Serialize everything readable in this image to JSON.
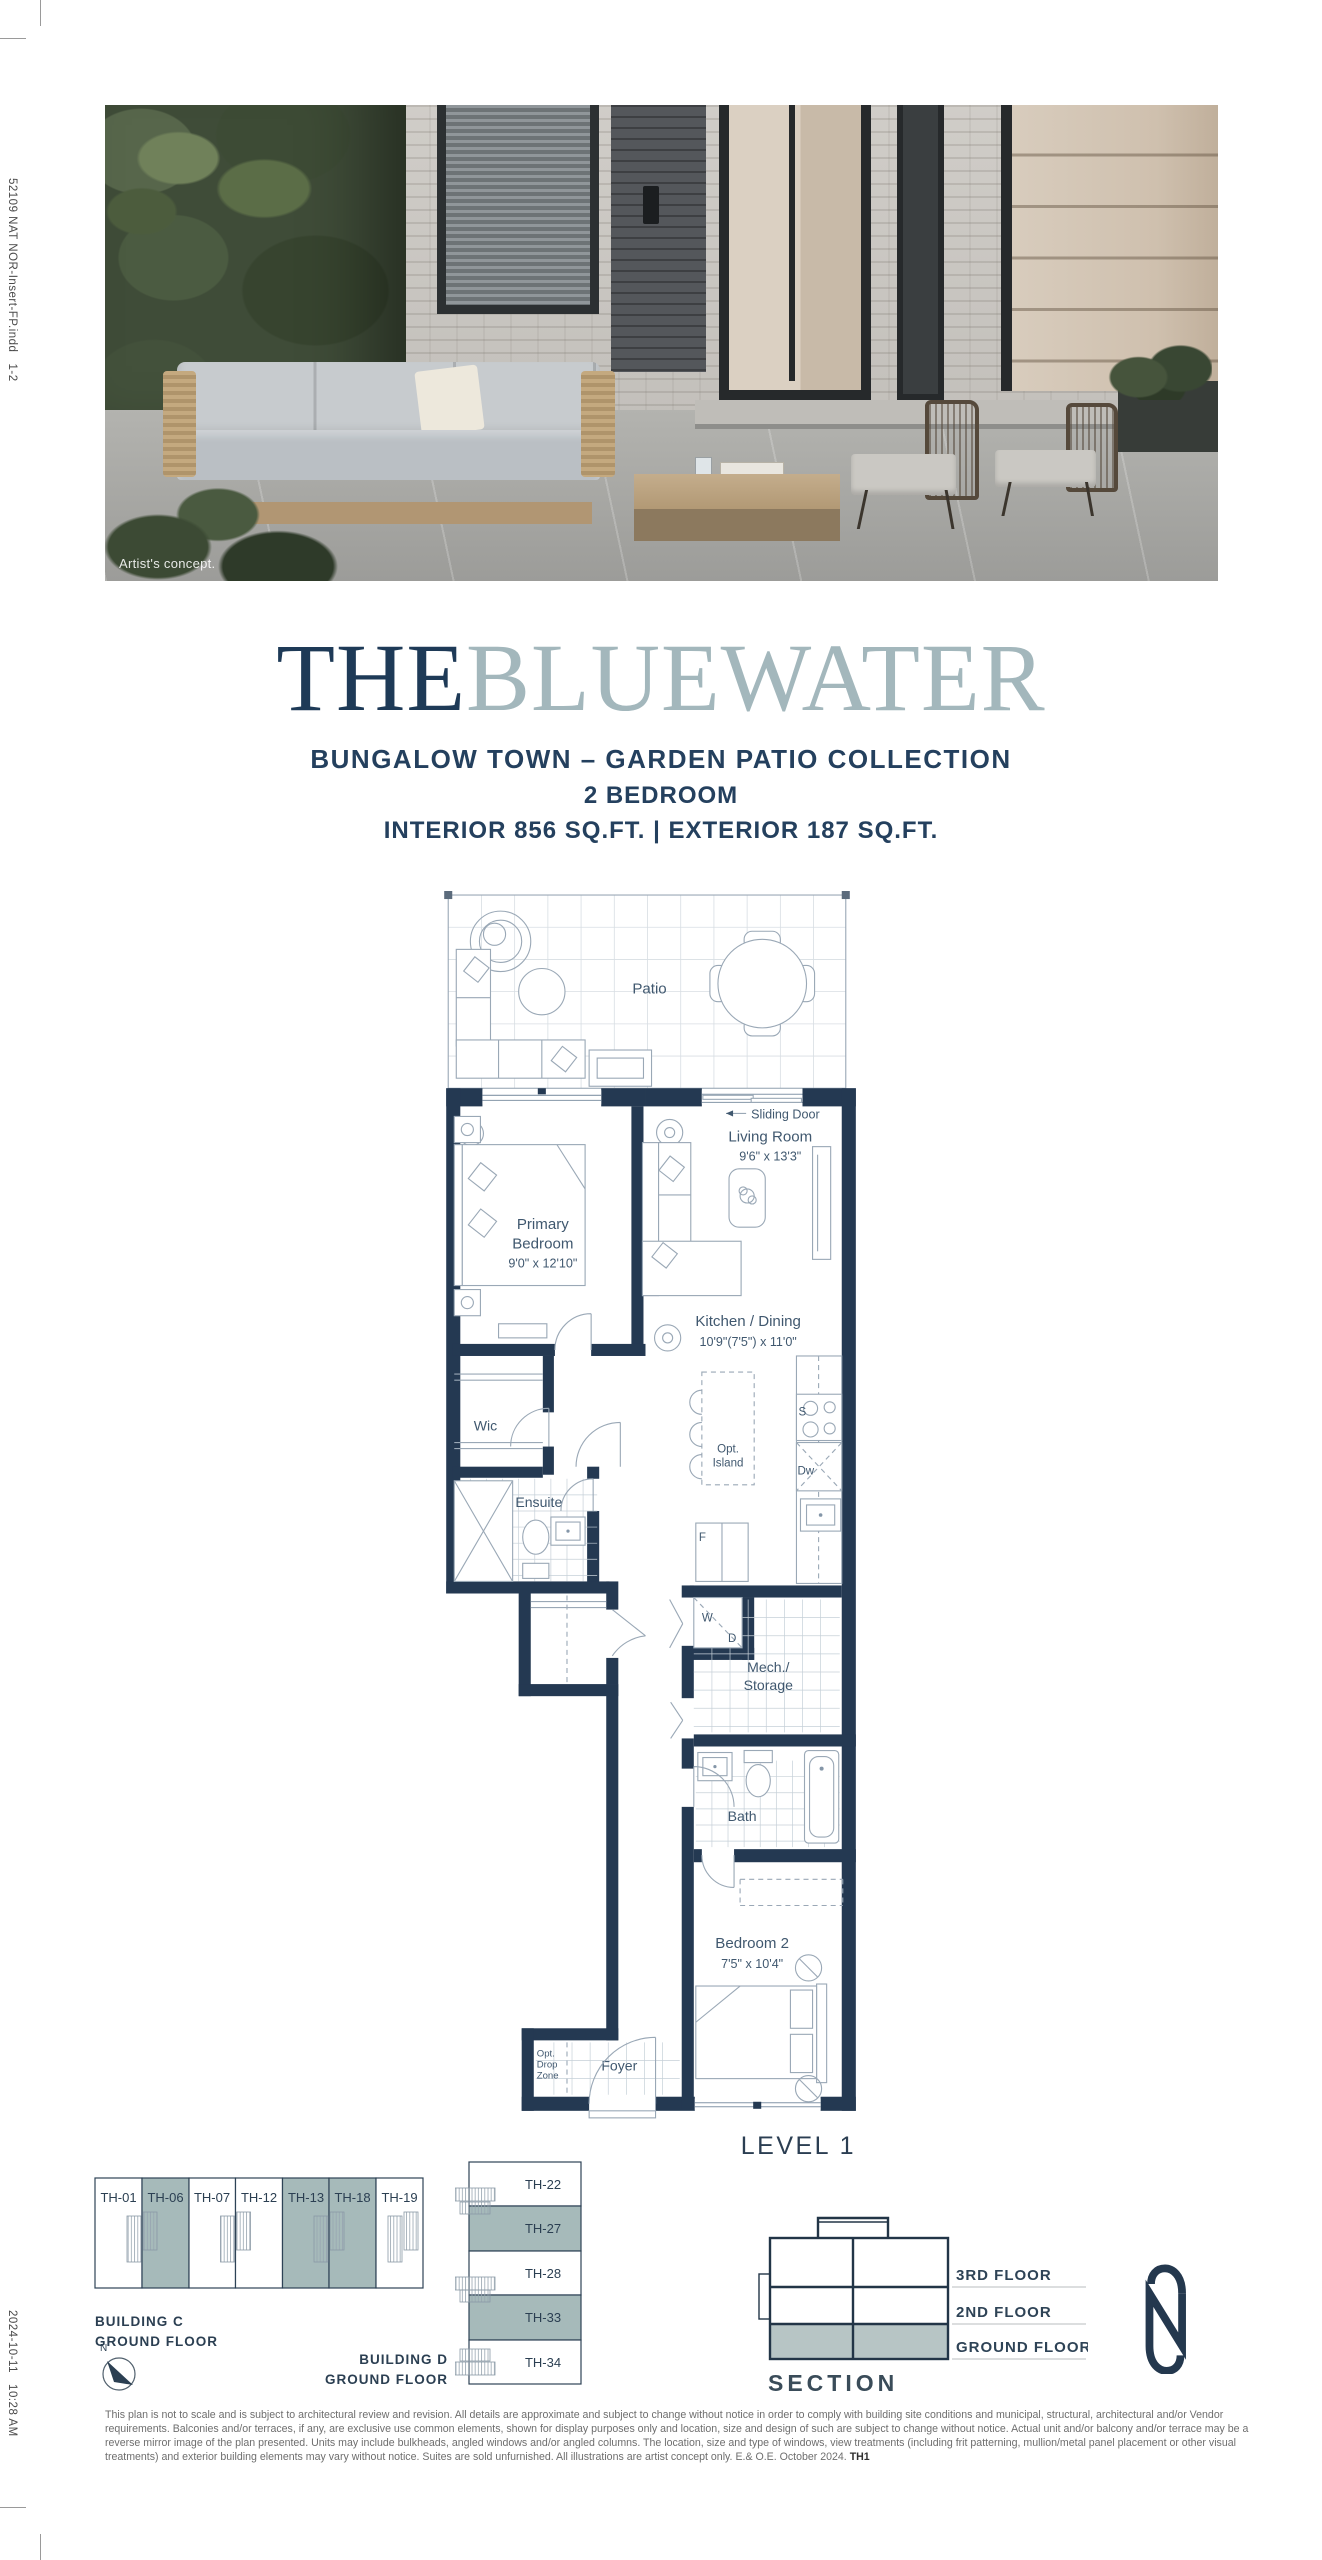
{
  "slug": {
    "top": "52109 NAT NOR-Insert-FP.indd   1-2",
    "bottom": "2024-10-11   10:28 AM"
  },
  "hero": {
    "caption": "Artist's concept."
  },
  "title": {
    "part1": "THE",
    "part2": "BLUEWATER"
  },
  "subtitle": {
    "collection": "BUNGALOW TOWN – GARDEN PATIO COLLECTION",
    "bedrooms": "2 BEDROOM",
    "area": "INTERIOR 856 SQ.FT.  |  EXTERIOR 187 SQ.FT."
  },
  "floorplan": {
    "level": "LEVEL 1",
    "patio": "Patio",
    "sliding_door": "Sliding Door",
    "living": {
      "name": "Living Room",
      "dims": "9'6\" x 13'3\""
    },
    "primary": {
      "name1": "Primary",
      "name2": "Bedroom",
      "dims": "9'0\" x 12'10\""
    },
    "kitchen": {
      "name": "Kitchen / Dining",
      "dims": "10'9\"(7'5\") x 11'0\""
    },
    "wic": "Wic",
    "ensuite": "Ensuite",
    "island": {
      "line1": "Opt.",
      "line2": "Island"
    },
    "mech": {
      "line1": "Mech./",
      "line2": "Storage"
    },
    "bath": "Bath",
    "bedroom2": {
      "name": "Bedroom 2",
      "dims": "7'5\" x 10'4\""
    },
    "foyer": "Foyer",
    "dropzone": {
      "line1": "Opt.",
      "line2": "Drop",
      "line3": "Zone"
    },
    "appliances": {
      "washer": "W",
      "dryer": "D",
      "stove": "S",
      "dishwasher": "Dw",
      "fridge": "F"
    }
  },
  "keyplans": {
    "building_c": {
      "label1": "BUILDING C",
      "label2": "GROUND FLOOR",
      "units": [
        {
          "id": "TH-01",
          "highlight": false
        },
        {
          "id": "TH-06",
          "highlight": true
        },
        {
          "id": "TH-07",
          "highlight": false
        },
        {
          "id": "TH-12",
          "highlight": false
        },
        {
          "id": "TH-13",
          "highlight": true
        },
        {
          "id": "TH-18",
          "highlight": true
        },
        {
          "id": "TH-19",
          "highlight": false
        }
      ]
    },
    "building_d": {
      "label1": "BUILDING D",
      "label2": "GROUND FLOOR",
      "units": [
        {
          "id": "TH-22",
          "highlight": false
        },
        {
          "id": "TH-27",
          "highlight": true
        },
        {
          "id": "TH-28",
          "highlight": false
        },
        {
          "id": "TH-33",
          "highlight": true
        },
        {
          "id": "TH-34",
          "highlight": false
        }
      ]
    },
    "compass_label": "N"
  },
  "section": {
    "title": "SECTION",
    "floor3": "3RD FLOOR",
    "floor2": "2ND FLOOR",
    "floor1": "GROUND FLOOR"
  },
  "disclaimer": {
    "text": "This plan is not to scale and is subject to architectural review and revision. All details are approximate and subject to change without notice in order to comply with building site conditions and municipal, structural, architectural and/or Vendor requirements. Balconies and/or terraces, if any, are exclusive use common elements, shown for display purposes only and location, size and design of such are subject to change without notice. Actual unit and/or balcony and/or terrace may be a reverse mirror image of the plan presented. Units may include bulkheads, angled windows and/or angled columns. The location, size and type of windows, view treatments (including frit patterning, mullion/metal panel placement or other visual treatments) and exterior building elements may vary without notice. Suites are sold unfurnished. All illustrations are artist concept only. E.& O.E. October 2024. ",
    "unit_code": "TH1"
  },
  "colors": {
    "navy_wall": "#243952",
    "title_navy": "#1E3A57",
    "title_blue": "#A3B7BC",
    "teal_highlight": "#A6BABA",
    "plan_line": "#9AA8B6",
    "plan_text": "#40586F"
  }
}
